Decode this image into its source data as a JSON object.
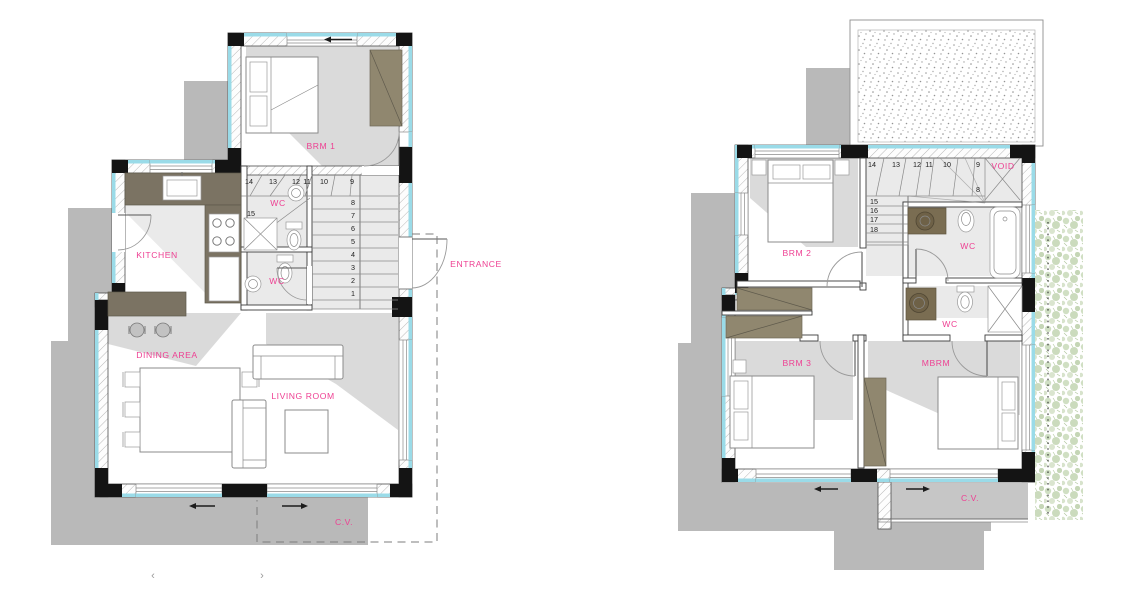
{
  "colors": {
    "label_pink": "#ee3f92",
    "wall_cyan": "#9adbe8",
    "column_black": "#141414",
    "shadow_gray": "#b9b9b9",
    "wardrobe_tan": "#90876f",
    "kitchen_counter_olive": "#7b7363",
    "greenery_green": "#c4d6b2"
  },
  "ground_floor": {
    "rooms": {
      "brm1": "BRM 1",
      "wc_top": "WC",
      "wc_bottom": "WC",
      "kitchen": "KITCHEN",
      "entrance": "ENTRANCE",
      "dining": "DINING AREA",
      "living": "LIVING ROOM",
      "cv": "C.V."
    },
    "stairs": {
      "top_row": [
        "14",
        "13",
        "12",
        "11",
        "10",
        "9"
      ],
      "landing": "15",
      "flight": [
        "8",
        "7",
        "6",
        "5",
        "4",
        "3",
        "2",
        "1"
      ]
    }
  },
  "first_floor": {
    "rooms": {
      "void": "VOID",
      "wc_top": "WC",
      "wc_mid": "WC",
      "brm2": "BRM 2",
      "brm3": "BRM 3",
      "mbrm": "MBRM",
      "cv": "C.V."
    },
    "stairs": {
      "top_row": [
        "14",
        "13",
        "12",
        "11",
        "10",
        "9"
      ],
      "winder": "8",
      "flight": [
        "15",
        "16",
        "17",
        "18"
      ]
    }
  },
  "pager": {
    "prev": "‹",
    "next": "›"
  }
}
